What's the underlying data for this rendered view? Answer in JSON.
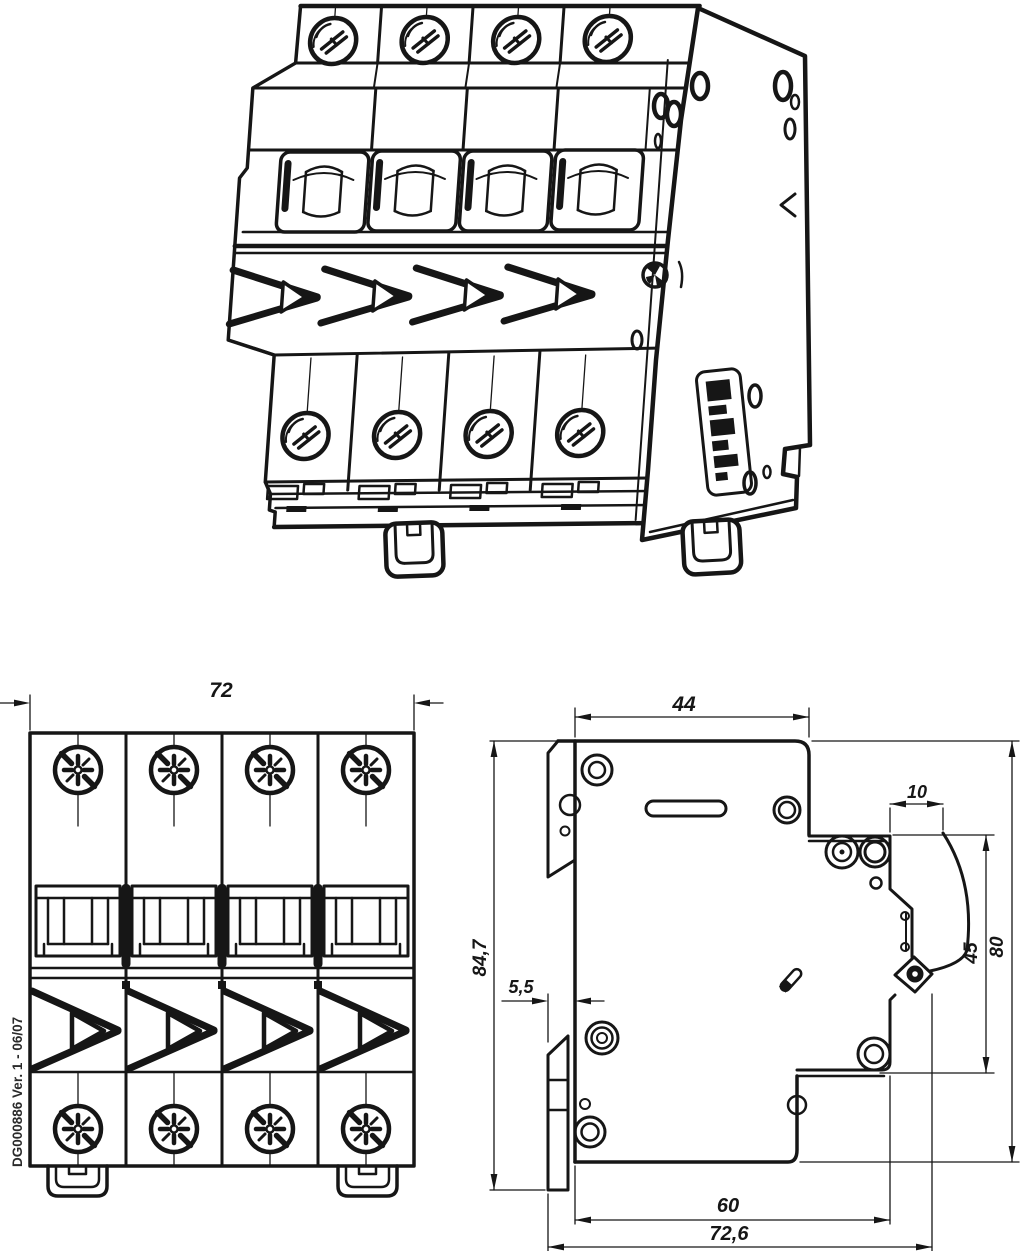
{
  "page": {
    "background": "#ffffff",
    "line_color": "#161616"
  },
  "drawing": {
    "code_label": "DG000886 Ver. 1 - 06/07",
    "front_view": {
      "dim_width": "72"
    },
    "side_view": {
      "dim_depth_top": "44",
      "dim_terminal_depth": "10",
      "dim_height_with_clip": "84,7",
      "dim_clip_offset": "5,5",
      "dim_terminal_span": "45",
      "dim_height_body": "80",
      "dim_depth_base": "60",
      "dim_depth_overall": "72,6"
    }
  }
}
